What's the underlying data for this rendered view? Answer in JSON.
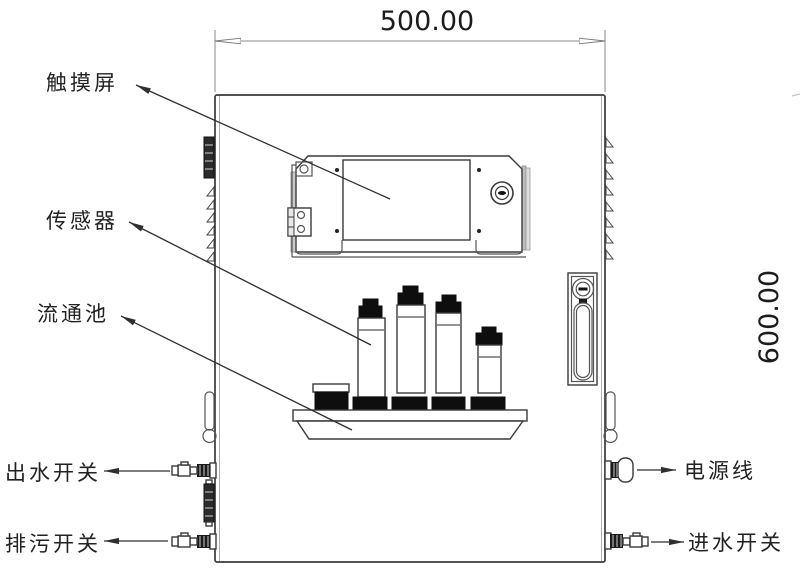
{
  "drawing": {
    "title_hint": "wall-mounted analyzer cabinet front view",
    "dimensions": {
      "width_label": "500.00",
      "height_label": "600.00"
    },
    "labels": {
      "touchscreen": "触摸屏",
      "sensor": "传感器",
      "flow_cell": "流通池",
      "outlet_switch": "出水开关",
      "drain_switch": "排污开关",
      "power_cable": "电源线",
      "inlet_switch": "进水开关"
    },
    "colors": {
      "line": "#3a3a3a",
      "fill_black": "#0e0e0e",
      "dim_line": "#8a8a8a",
      "background": "#ffffff"
    }
  }
}
